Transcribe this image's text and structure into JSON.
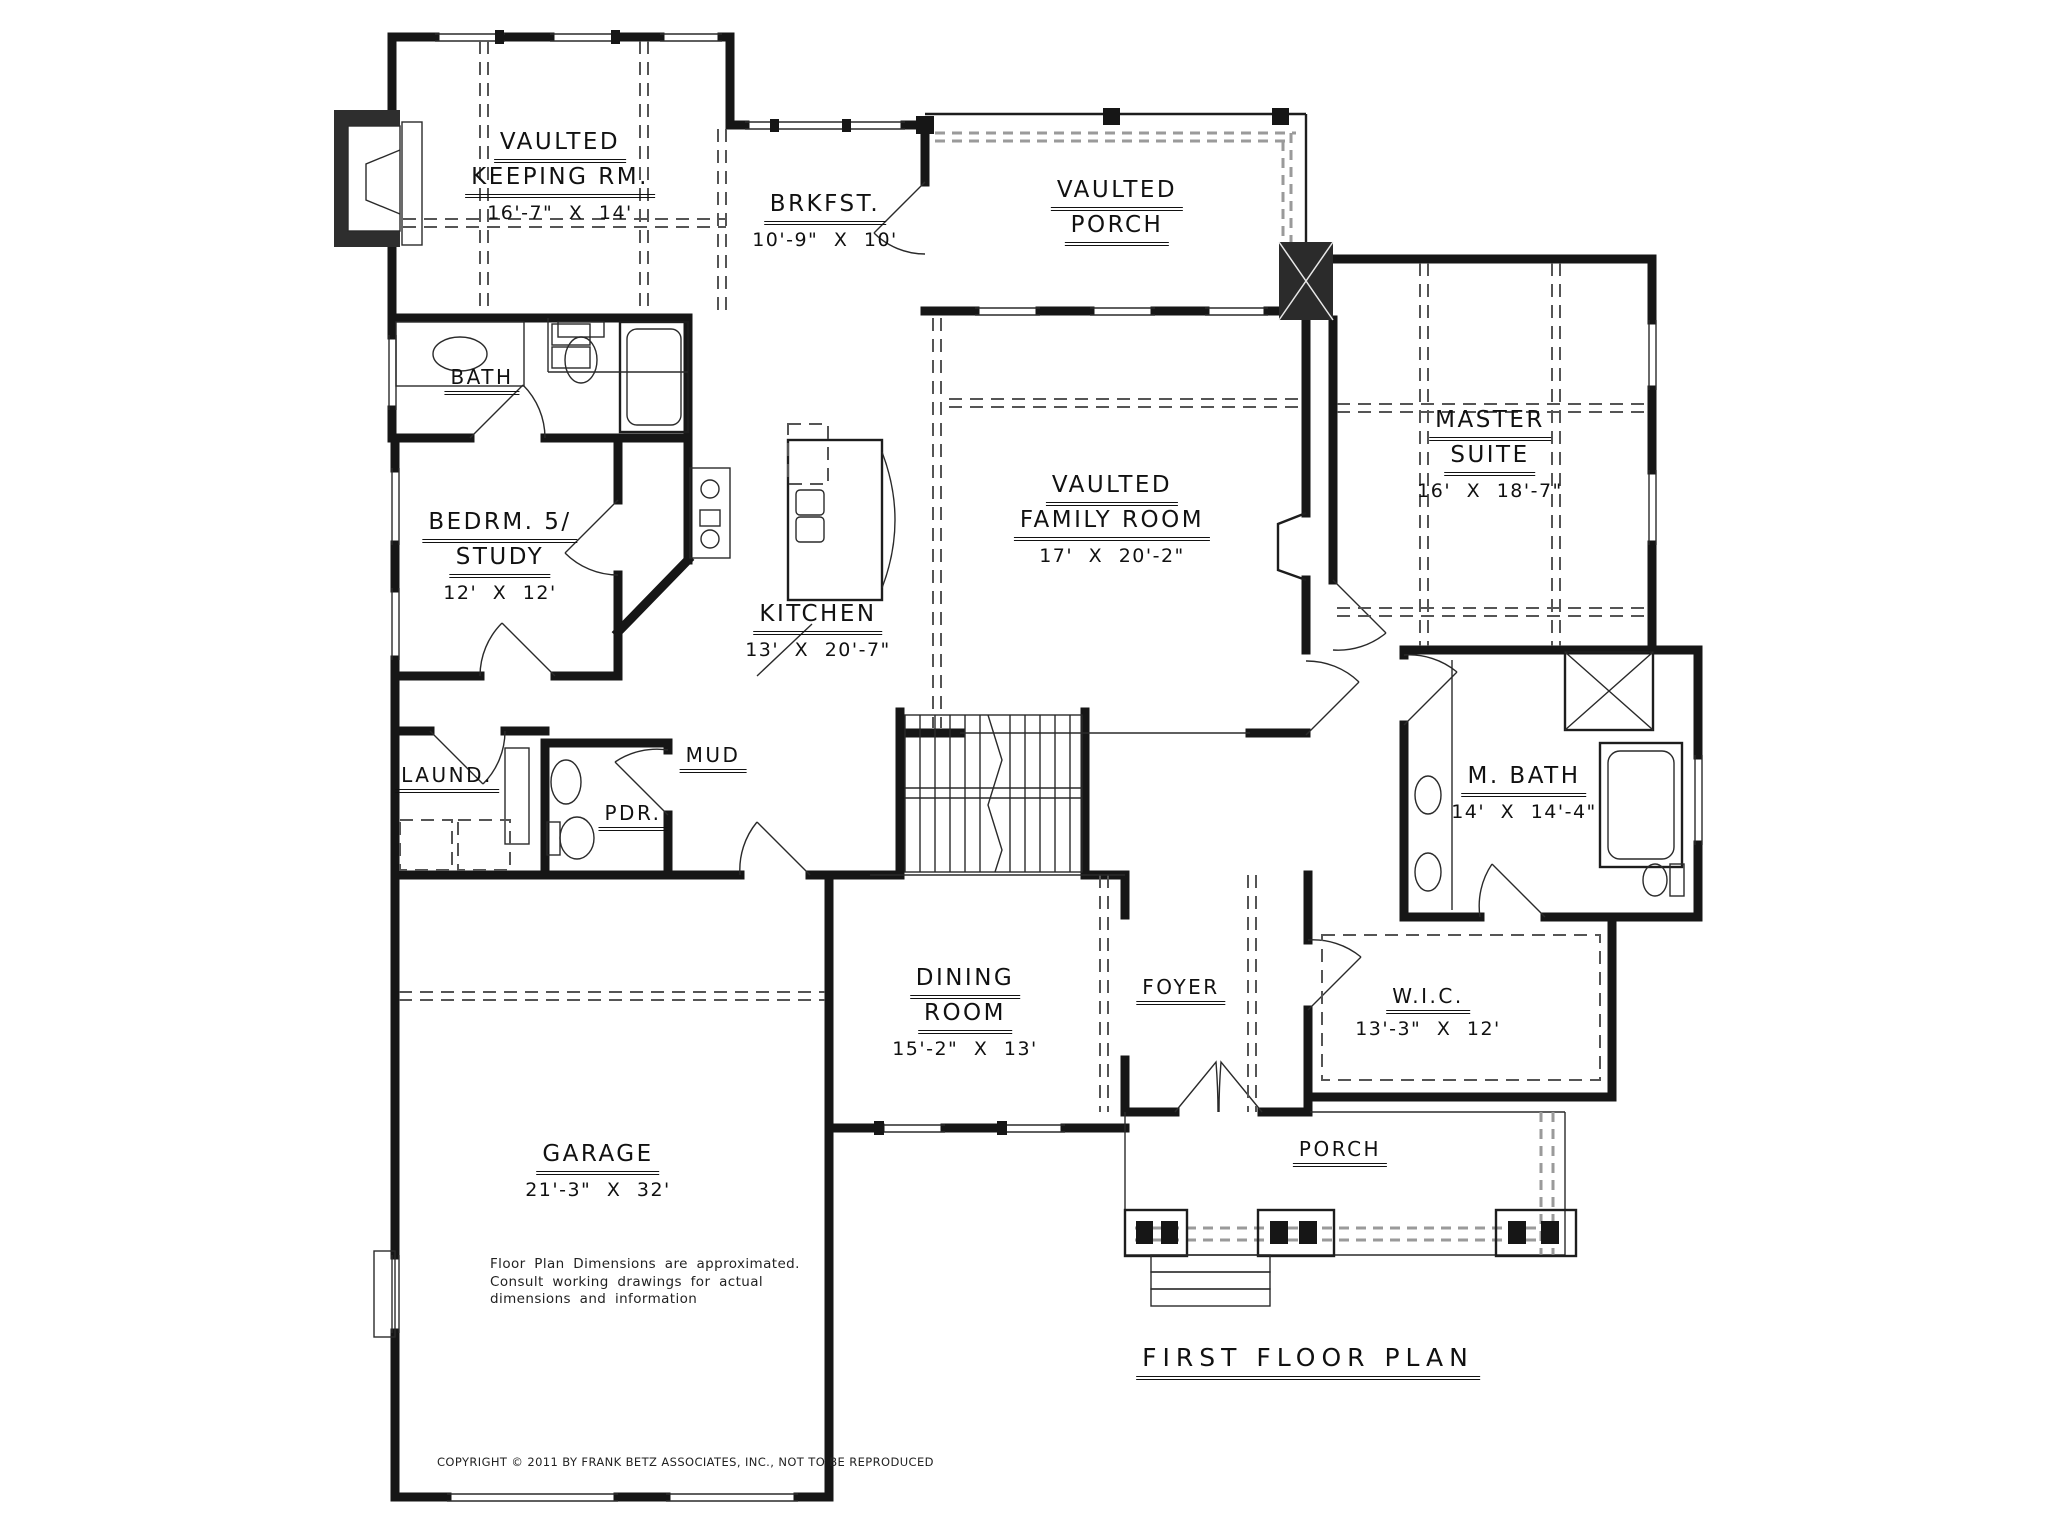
{
  "plan": {
    "title": "FIRST FLOOR PLAN",
    "copyright": "COPYRIGHT © 2011 BY FRANK BETZ ASSOCIATES, INC., NOT TO BE REPRODUCED",
    "disclaimer": {
      "line1": "Floor Plan Dimensions are approximated.",
      "line2": "Consult working drawings for actual",
      "line3": "dimensions and information"
    }
  },
  "rooms": {
    "keeping": {
      "line1": "VAULTED",
      "line2": "KEEPING RM.",
      "dims": "16'-7\" X 14'"
    },
    "brkfst": {
      "line1": "BRKFST.",
      "dims": "10'-9\" X 10'"
    },
    "vaulted_porch": {
      "line1": "VAULTED",
      "line2": "PORCH"
    },
    "master": {
      "line1": "MASTER",
      "line2": "SUITE",
      "dims": "16' X 18'-7\""
    },
    "bath": {
      "line1": "BATH"
    },
    "bedroom5": {
      "line1": "BEDRM. 5/",
      "line2": "STUDY",
      "dims": "12' X 12'"
    },
    "kitchen": {
      "line1": "KITCHEN",
      "dims": "13' X 20'-7\""
    },
    "family": {
      "line1": "VAULTED",
      "line2": "FAMILY ROOM",
      "dims": "17' X 20'-2\""
    },
    "laundry": {
      "line1": "LAUND."
    },
    "mud": {
      "line1": "MUD"
    },
    "powder": {
      "line1": "PDR."
    },
    "mbath": {
      "line1": "M. BATH",
      "dims": "14' X 14'-4\""
    },
    "dining": {
      "line1": "DINING",
      "line2": "ROOM",
      "dims": "15'-2\" X 13'"
    },
    "foyer": {
      "line1": "FOYER"
    },
    "wic": {
      "line1": "W.I.C.",
      "dims": "13'-3\" X 12'"
    },
    "garage": {
      "line1": "GARAGE",
      "dims": "21'-3\" X 32'"
    },
    "porch": {
      "line1": "PORCH"
    }
  }
}
